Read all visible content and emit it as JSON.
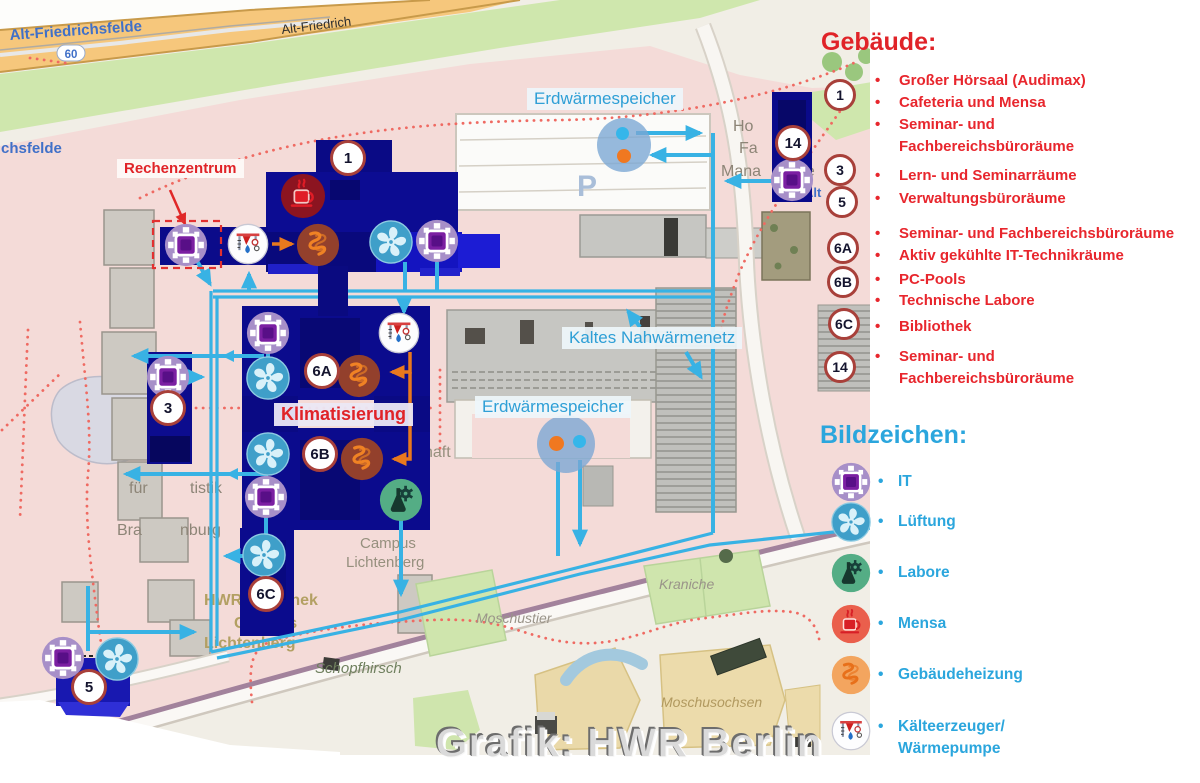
{
  "watermark": "Grafik: HWR Berlin",
  "colors": {
    "network_cyan": "#38b2e4",
    "legend_blue": "#2ba6dd",
    "legend_red": "#e8262d",
    "arrow_orange": "#e8791e",
    "building_navy": "#0b0b8c"
  },
  "panel": {
    "buildings_heading": "Gebäude:",
    "symbols_heading": "Bildzeichen:",
    "building_badges": [
      "1",
      "3",
      "5",
      "6A",
      "6B",
      "6C",
      "14"
    ],
    "building_items": [
      {
        "text": "Großer Hörsaal (Audimax)",
        "bullet": true
      },
      {
        "text": "Cafeteria und Mensa",
        "bullet": true
      },
      {
        "text": "Seminar- und",
        "bullet": true
      },
      {
        "text": "Fachbereichsbüroräume",
        "bullet": false
      },
      {
        "text": "Lern- und Seminarräume",
        "bullet": true
      },
      {
        "text": "Verwaltungsbüroräume",
        "bullet": true
      },
      {
        "text": "Seminar- und Fachbereichsbüroräume",
        "bullet": true
      },
      {
        "text": "Aktiv gekühlte IT-Technikräume",
        "bullet": true
      },
      {
        "text": "PC-Pools",
        "bullet": true
      },
      {
        "text": "Technische Labore",
        "bullet": true
      },
      {
        "text": "Bibliothek",
        "bullet": true
      },
      {
        "text": "Seminar- und",
        "bullet": true
      },
      {
        "text": "Fachbereichsbüroräume",
        "bullet": false
      }
    ],
    "symbols": [
      "IT",
      "Lüftung",
      "Labore",
      "Mensa",
      "Gebäudeheizung",
      "Kälteerzeuger/",
      "Wärmepumpe"
    ]
  },
  "map": {
    "badges": [
      "1",
      "14",
      "3",
      "6A",
      "6B",
      "6C",
      "5"
    ],
    "labels": {
      "rechenzentrum": "Rechenzentrum",
      "erdwaermespeicher_top": "Erdwärmespeicher",
      "erdwaermespeicher_bottom": "Erdwärmespeicher",
      "kaltes_nahwaermenetz": "Kaltes Nahwärmenetz",
      "klimatisierung": "Klimatisierung"
    },
    "bg_texts": [
      "Alt-Friedrichsfelde",
      "60",
      "Alt-Friedrich",
      "chsfelde",
      "Ho",
      "ef",
      "Fa",
      "y",
      "Mana",
      "ne",
      "P",
      "ochschule",
      "Hochschule",
      "haft",
      "Berlin",
      "Campus",
      "Lichtenberg",
      "für",
      "tistik",
      "Bra",
      "nburg",
      "HWR",
      "thek",
      "Campus",
      "Lichtenberg",
      "Schopfhirsch",
      "Moschustier",
      "Kraniche",
      "Moschusochsen",
      "Alt"
    ]
  }
}
